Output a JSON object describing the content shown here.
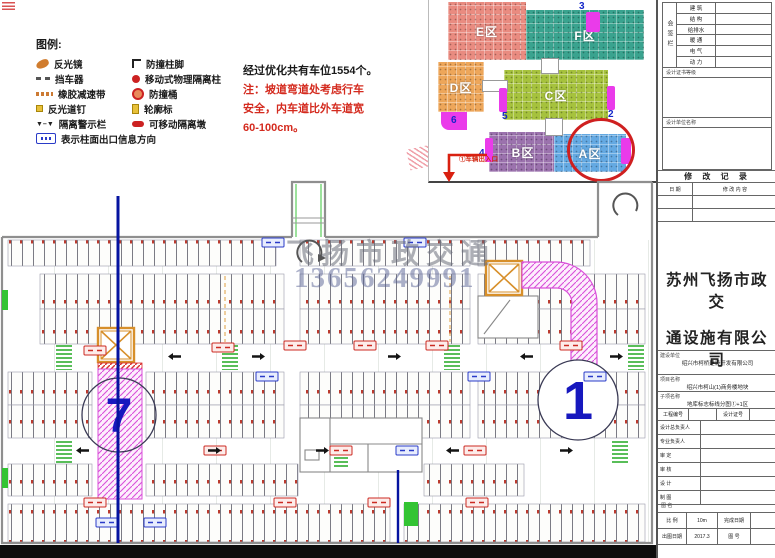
{
  "legend": {
    "title": "图例:",
    "left": [
      {
        "icon": "reflector-mirror",
        "label": "反光镜"
      },
      {
        "icon": "car-stopper",
        "label": "挡车器"
      },
      {
        "icon": "rubber-speed-bump",
        "label": "橡胶减速带"
      },
      {
        "icon": "reflective-road-stud",
        "label": "反光道钉"
      },
      {
        "icon": "isolation-warning-fence",
        "label": "隔离警示栏"
      }
    ],
    "right": [
      {
        "icon": "anti-collision-column-foot",
        "label": "防撞柱脚"
      },
      {
        "icon": "movable-isolation-column",
        "label": "移动式物理隔离柱"
      },
      {
        "icon": "anti-collision-barrel",
        "label": "防撞桶"
      },
      {
        "icon": "contour-marker",
        "label": "轮廓标"
      },
      {
        "icon": "movable-isolation-pier",
        "label": "可移动隔离墩"
      }
    ],
    "wide": {
      "icon": "column-exit-info-sign",
      "label": "表示柱面出口信息方向"
    }
  },
  "note": {
    "line1": "经过优化共有车位1554个。",
    "line2": "注：坡道弯道处考虑行车",
    "line3": "安全，内车道比外车道宽",
    "line4": "60-100cm。"
  },
  "overview": {
    "zones": {
      "E": "E区",
      "F": "F区",
      "D": "D区",
      "C": "C区",
      "B": "B区",
      "A": "A区"
    },
    "numbers": {
      "n3": "3",
      "n6": "6",
      "n5": "5",
      "n2": "2",
      "n4": "4"
    },
    "entrance_label": "①车辆出入口"
  },
  "plan": {
    "ramp_left_number": "7",
    "ramp_right_number": "1",
    "watermark_text": "飞扬市政交通",
    "watermark_phone": "13656249991"
  },
  "titleblock": {
    "signoff_col": "会签栏",
    "signoff_rows": [
      "建 筑",
      "结 构",
      "给排水",
      "暖 通",
      "电 气",
      "动 力"
    ],
    "cert_label": "设计证书等级",
    "design_org_label": "设计单位名称",
    "revision_header": "修 改 记 录",
    "rev_col_date": "日 期",
    "rev_col_desc": "修 改 内 容",
    "company_line1": "苏州飞扬市政交",
    "company_line2": "通设施有限公司",
    "client_label": "建设单位",
    "client_value": "绍兴市柯桥建设开发有限公司",
    "project_label": "项目名称",
    "project_value": "绍兴市柯山(1)商务楼地块",
    "subitem_label": "子项名称",
    "subitem_value": "地库标志标线分图①+1区",
    "grid1_label1": "工程编号",
    "grid1_label2": "设计证号",
    "role_rows": [
      "设计总负责人",
      "专业负责人",
      "审  定",
      "审  核",
      "设  计",
      "制  图"
    ],
    "drawing_name_label": "图 名",
    "scale_label": "比 例",
    "scale_value": "10m",
    "done_label": "完成日期",
    "date_label": "出图日期",
    "date_value": "2017.3",
    "fig_label": "图 号"
  }
}
